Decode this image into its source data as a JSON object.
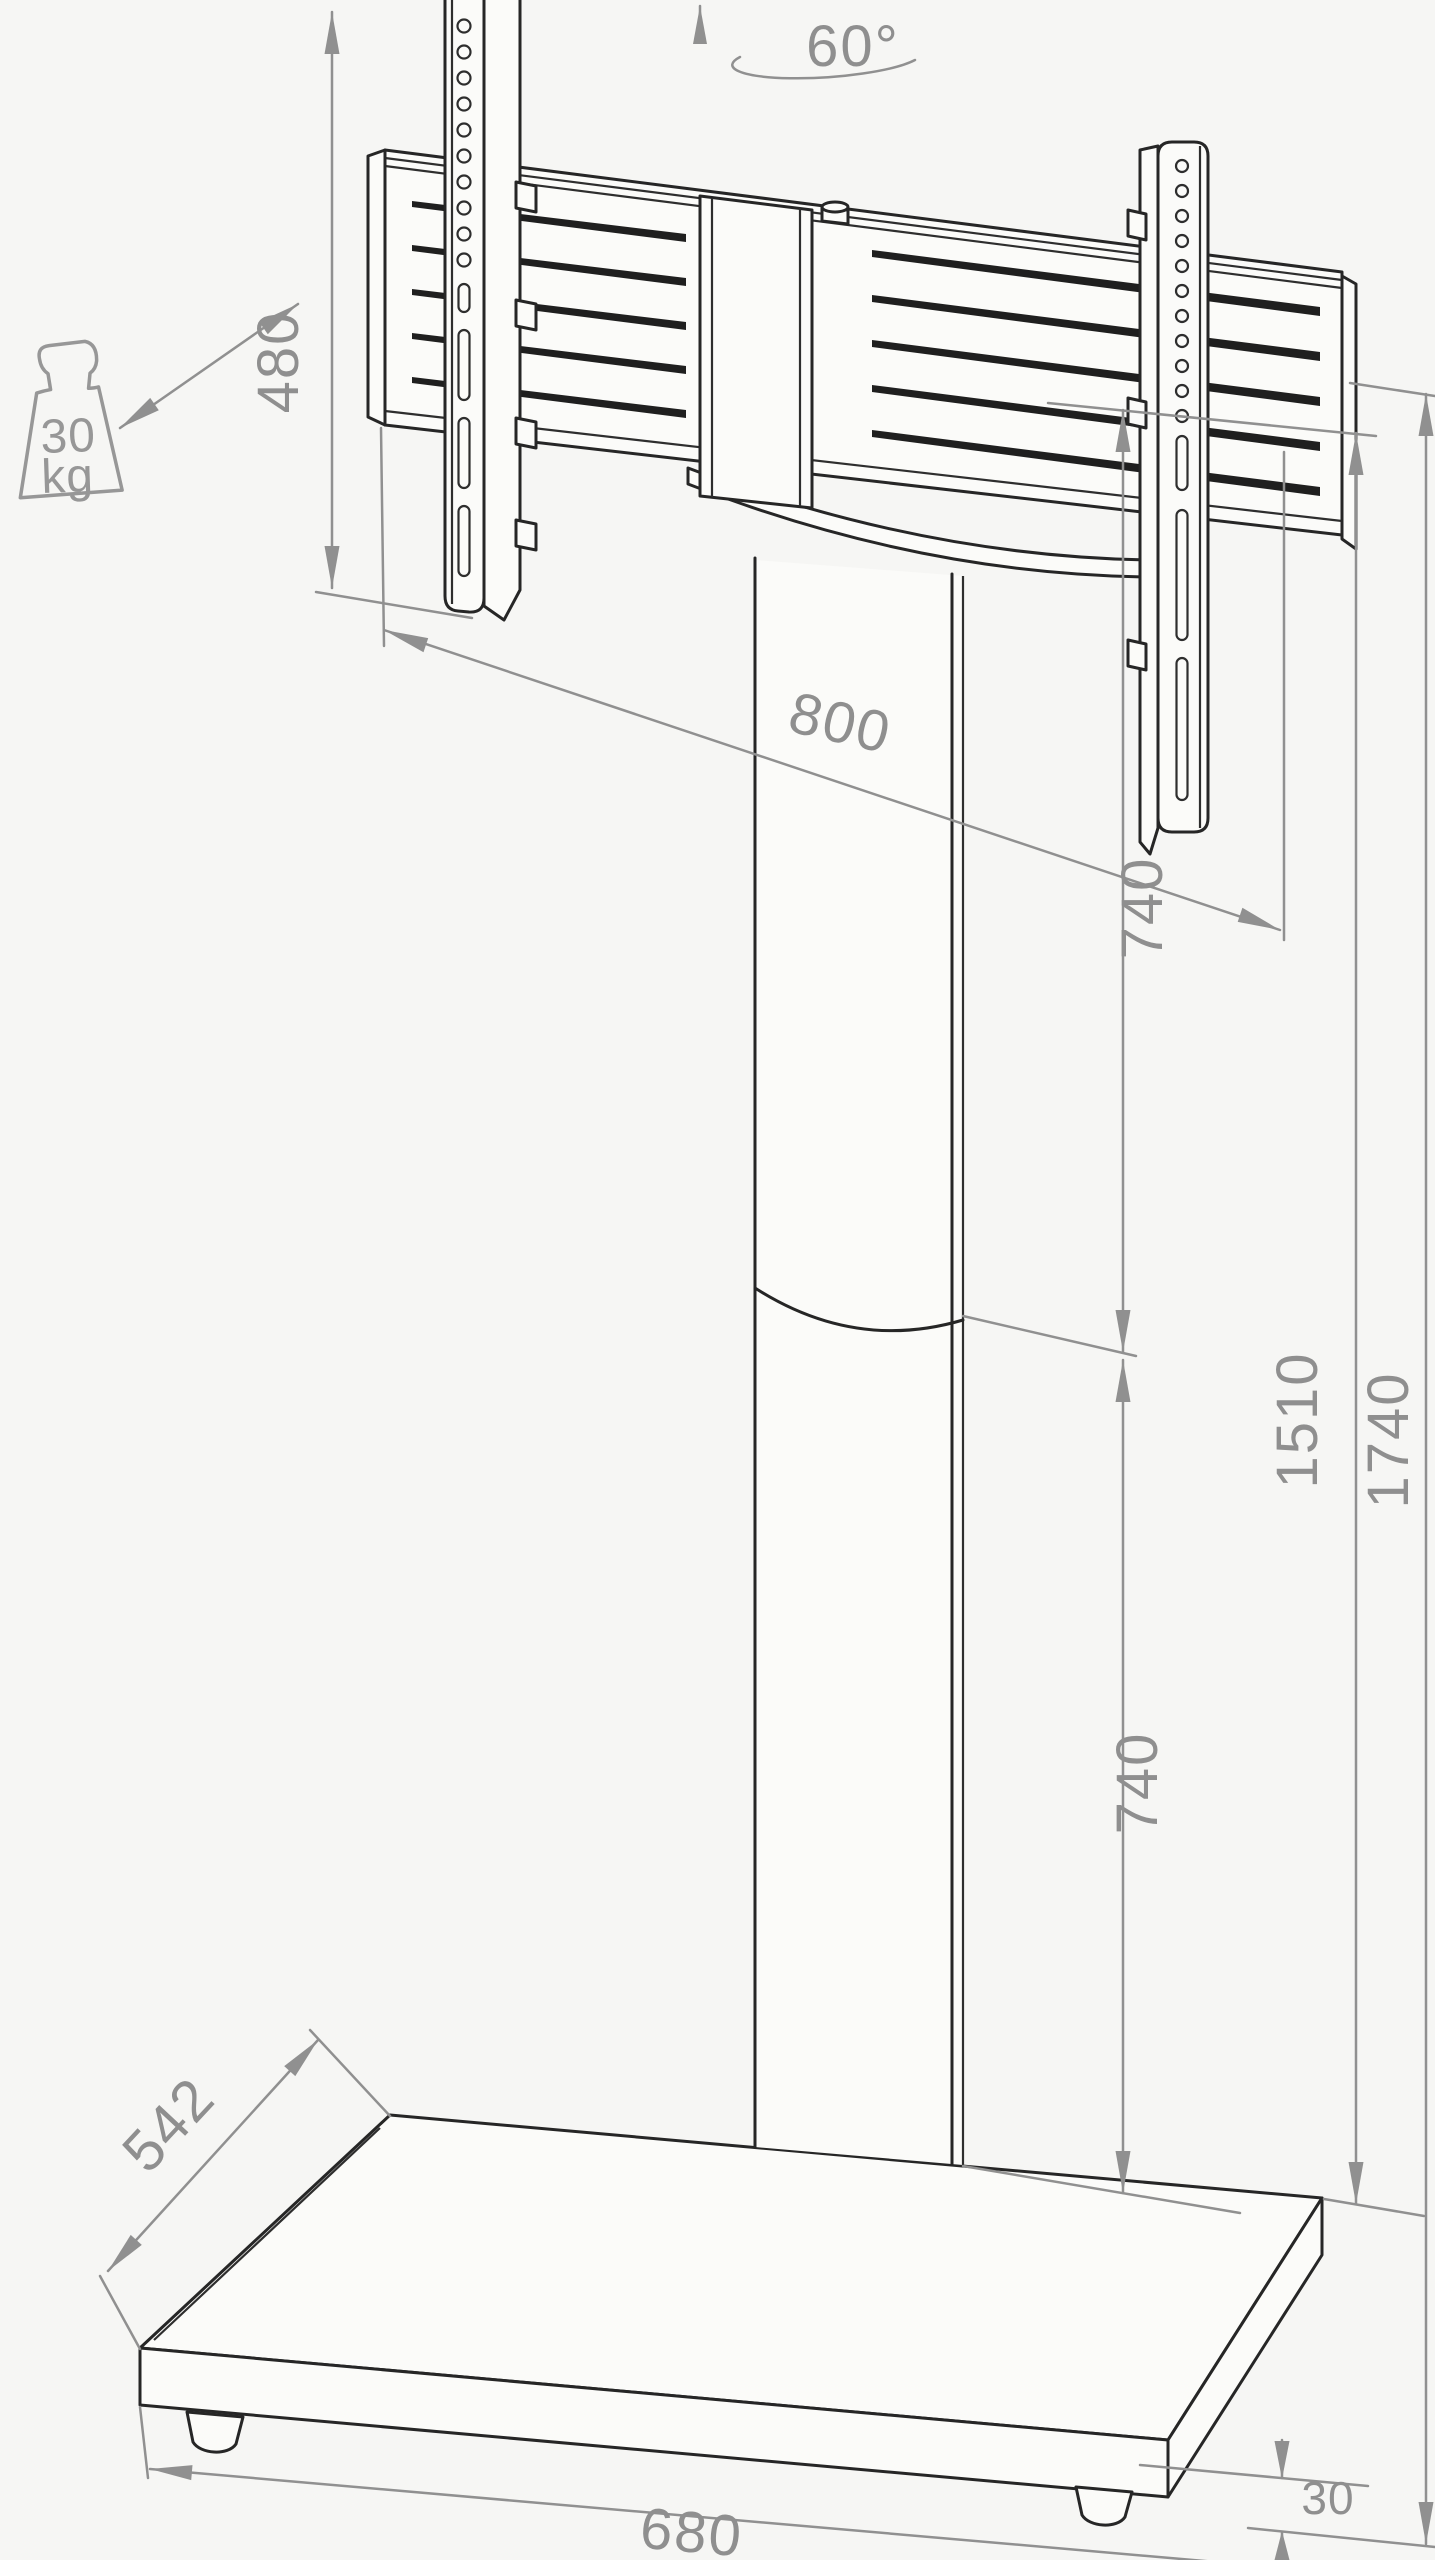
{
  "drawing": {
    "title": "TV floor stand with swivel mount - dimensional drawing",
    "angle": {
      "label": "60°"
    },
    "load_capacity": {
      "value": "30",
      "unit": "kg"
    },
    "dims": {
      "d480": "480",
      "d800": "800",
      "d740_upper": "740",
      "d1510": "1510",
      "d1740": "1740",
      "d740_lower": "740",
      "d542": "542",
      "d680": "680",
      "d30": "30"
    },
    "colors": {
      "line": "#262626",
      "dimension": "#909090",
      "background": "#f6f6f4"
    }
  }
}
